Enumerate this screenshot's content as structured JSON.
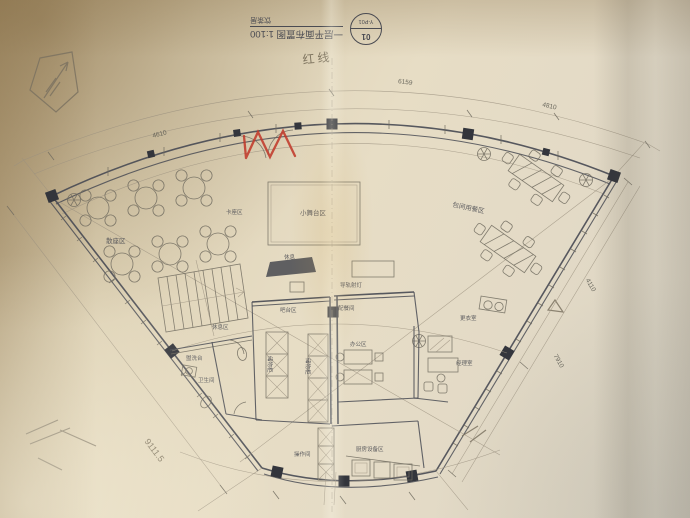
{
  "titleblock": {
    "stamp_top": "01",
    "stamp_bottom": "Y-P01",
    "drawing_title": "一层平面布置图 1:100",
    "project_name": "饮茶居"
  },
  "annotations": {
    "handwritten_note": "红线",
    "handwritten_dimension": "9111.5"
  },
  "dimensions": {
    "top_left": "4610",
    "top_center": "6159",
    "top_right": "4810",
    "right_upper": "4110",
    "right_lower": "7910"
  },
  "labels": {
    "dining_area": "散座区",
    "booth_area": "卡座区",
    "stage": "小舞台区",
    "rest_area": "休息",
    "track_light": "导轨射灯",
    "bar": "吧台区",
    "pantry": "配餐间",
    "cabinet_left": "储物柜",
    "cabinet_right": "储物柜",
    "office_mid": "办公区",
    "lounge": "休息区",
    "washstand": "盥洗台",
    "restroom": "卫生间",
    "changing_room": "更衣室",
    "manager_office": "经理室",
    "private_dining": "包间用餐区",
    "kitchen_equipment": "厨房设备区",
    "prep_room": "操作间"
  },
  "colors": {
    "ink": "#4a4c55",
    "pencil": "#7b7260",
    "red_marker": "#c03a2b",
    "paper": "#e3d8bf"
  }
}
